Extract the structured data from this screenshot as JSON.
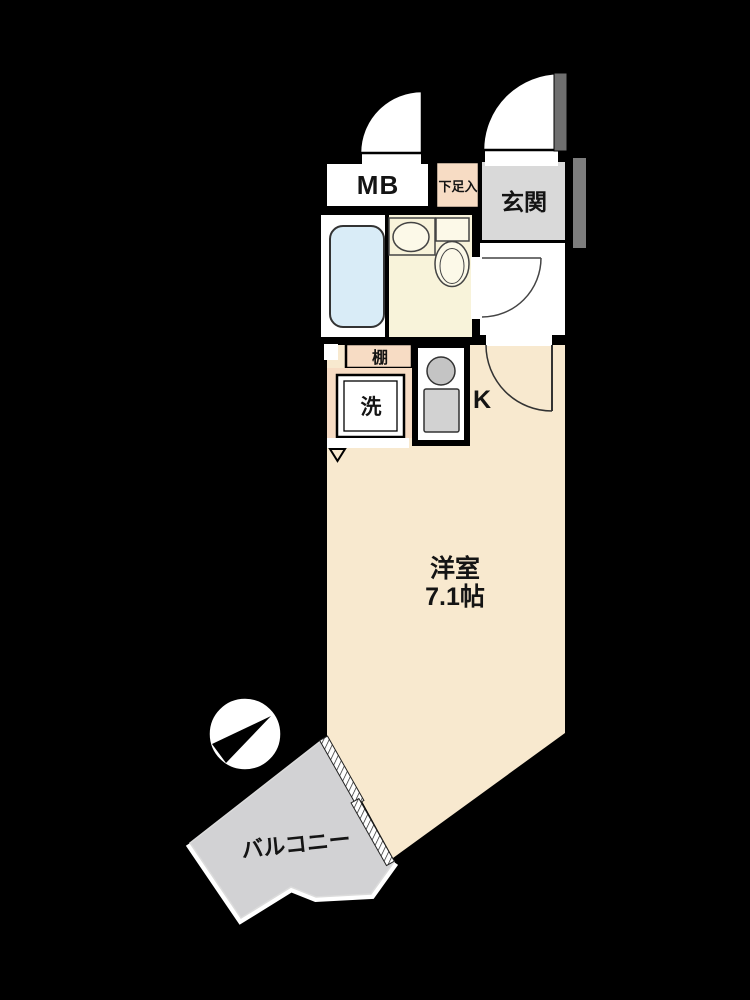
{
  "title": "apartment-floorplan",
  "labels": {
    "meter_box": "MB",
    "shoe_cabinet": "下足入",
    "entrance": "玄関",
    "shelf": "棚",
    "washer": "洗",
    "kitchen": "K",
    "room_name": "洋室",
    "room_size": "7.1帖",
    "balcony": "バルコニー"
  },
  "icons": {
    "north_indicator": "compass-circle-with-black-needle",
    "door_swings": "quarter-circle-arcs",
    "sliding_window": "diagonal-hatched-band",
    "vent_marker": "down-triangle-outline"
  },
  "colors": {
    "background": "#000000",
    "room_cream": "#f8e9cf",
    "bathroom_cream": "#f8f3da",
    "fixture_cream": "#fcf9e8",
    "tub_blue": "#d9ecf7",
    "peach": "#f7dcc4",
    "entrance_gray": "#d9d9d9",
    "balcony_gray": "#d2d2d4",
    "white": "#ffffff",
    "burner_gray": "#c4c4c4",
    "sink_gray": "#d2d2d2",
    "door_panel_gray": "#6f6f6f",
    "exterior_bar_gray": "#7d7d7d"
  }
}
